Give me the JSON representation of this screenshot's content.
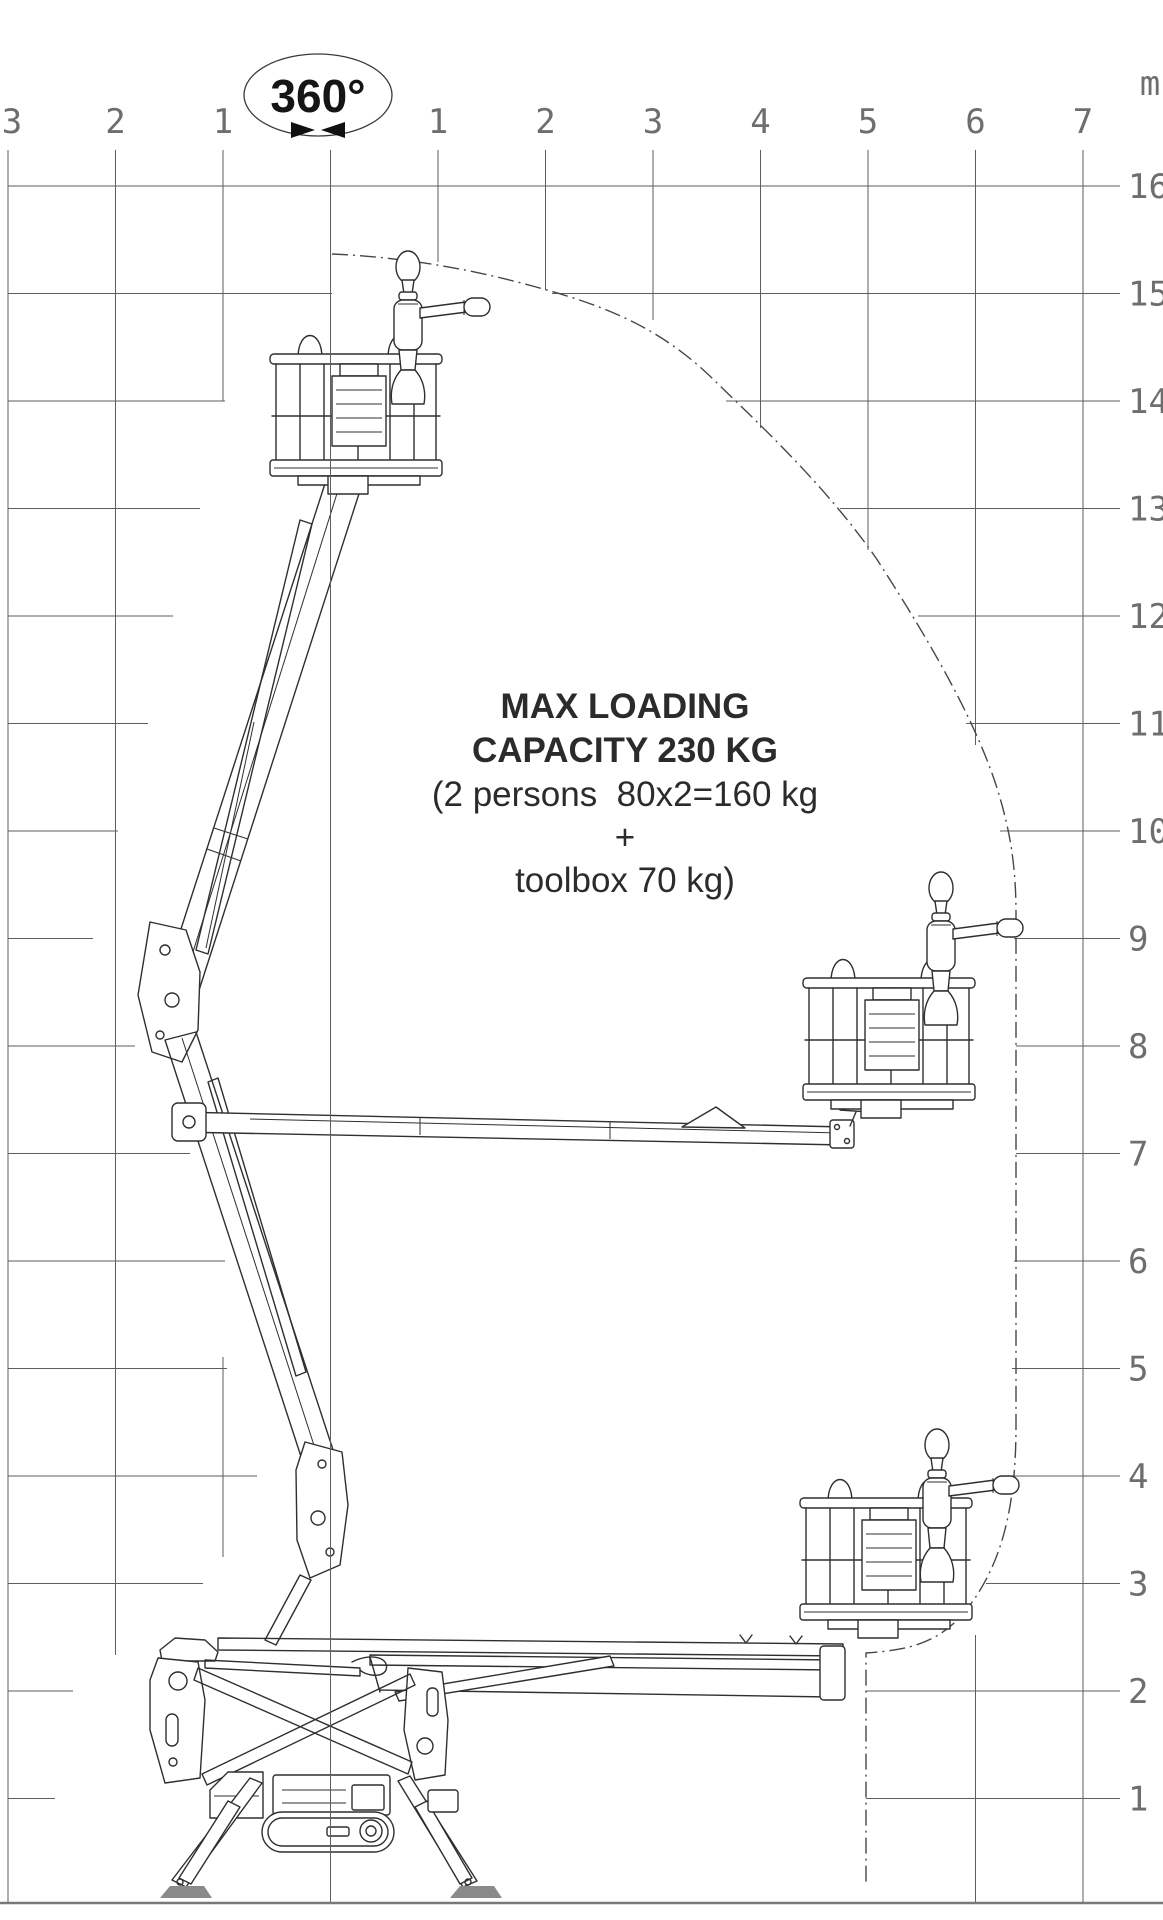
{
  "diagram": {
    "title_semantic": "Aerial platform working envelope diagram",
    "rotation_badge": "360°",
    "unit_label": "m",
    "axes": {
      "x_left": [
        "3",
        "2",
        "1"
      ],
      "x_right": [
        "1",
        "2",
        "3",
        "4",
        "5",
        "6",
        "7"
      ],
      "y": [
        "16",
        "15",
        "14",
        "13",
        "12",
        "11",
        "10",
        "9",
        "8",
        "7",
        "6",
        "5",
        "4",
        "3",
        "2",
        "1"
      ]
    },
    "capacity_note": {
      "line1": "MAX LOADING",
      "line2": "CAPACITY 230 KG",
      "line3": "(2 persons  80x2=160 kg",
      "line4": "+",
      "line5": "toolbox 70 kg)"
    },
    "colors": {
      "background": "#ffffff",
      "machine_line": "#2f2f2f",
      "grid_line": "#5e5e5e",
      "axis_text": "#6e6e6e",
      "envelope_line": "#474747",
      "foot_pad": "#8a8a8a"
    }
  }
}
